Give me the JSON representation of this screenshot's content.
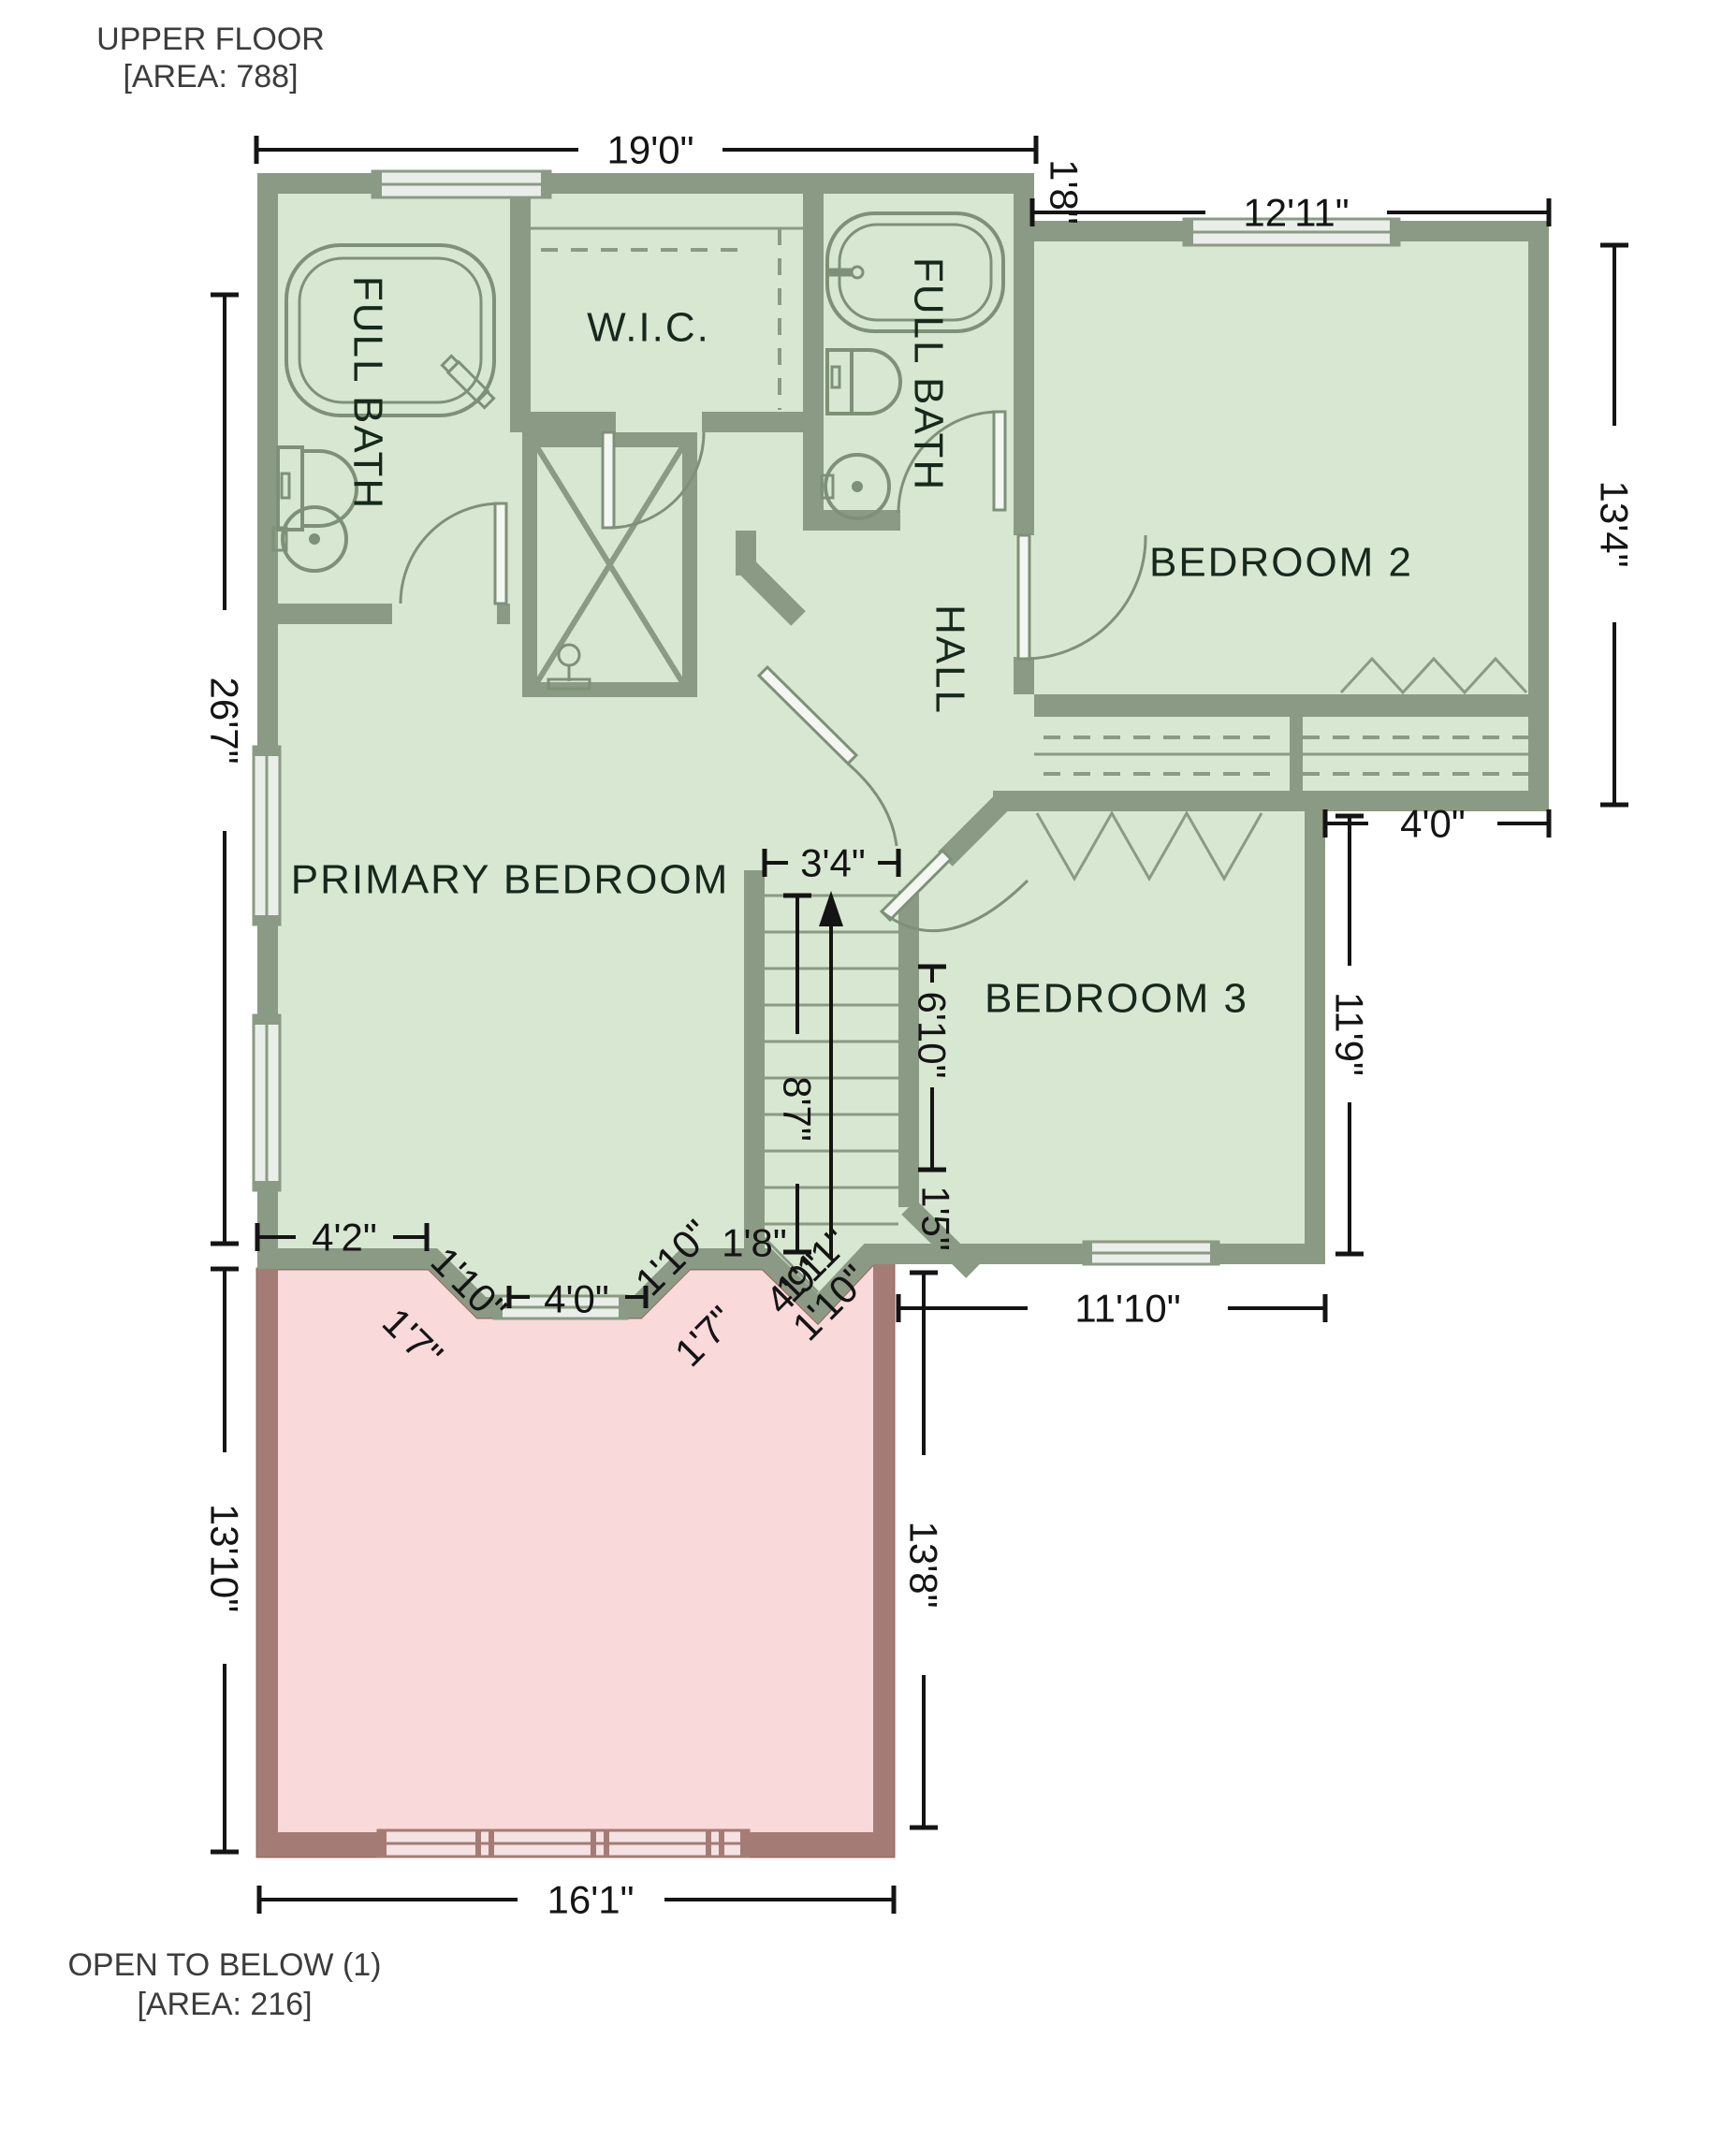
{
  "title": {
    "line1": "UPPER FLOOR",
    "line2": "[AREA: 788]"
  },
  "footnote": {
    "line1": "OPEN TO BELOW (1)",
    "line2": "[AREA: 216]"
  },
  "rooms": {
    "full_bath_left": "FULL BATH",
    "wic": "W.I.C.",
    "full_bath_right": "FULL BATH",
    "bedroom2": "BEDROOM 2",
    "hall": "HALL",
    "primary_bedroom": "PRIMARY BEDROOM",
    "bedroom3": "BEDROOM 3"
  },
  "dimensions": {
    "overall_width": "19'0\"",
    "step_right": "1'8\"",
    "bedroom2_width": "12'11\"",
    "bedroom2_height": "13'4\"",
    "left_height": "26'7\"",
    "right_step": "4'0\"",
    "bedroom3_height": "11'9\"",
    "stair_width": "3'4\"",
    "stair_length": "8'7\"",
    "bedroom3_left": "6'10\"",
    "corner": "1'5\"",
    "bedroom3_width": "11'10\"",
    "open_right_height": "13'8\"",
    "open_left_height": "13'10\"",
    "open_width": "16'1\"",
    "bay_left": "4'2\"",
    "bay_diag_left": "1'10\"",
    "bay_out_left": "1'7\"",
    "bay_window": "4'0\"",
    "bay_diag_right": "1'10\"",
    "bay_out_right": "1'7\"",
    "bay_flat_right": "1'8\"",
    "cluster_a": "4'9\"",
    "cluster_b": "1'11\"",
    "cluster_c": "1'10\""
  },
  "colors": {
    "wall": "#8b9a84",
    "room_fill": "#d8e7d1",
    "open_fill": "#f9d9d9",
    "open_wall": "#a57b75",
    "window_glass": "#e9efe8",
    "dim_text": "#141414",
    "room_text": "#17281c"
  }
}
